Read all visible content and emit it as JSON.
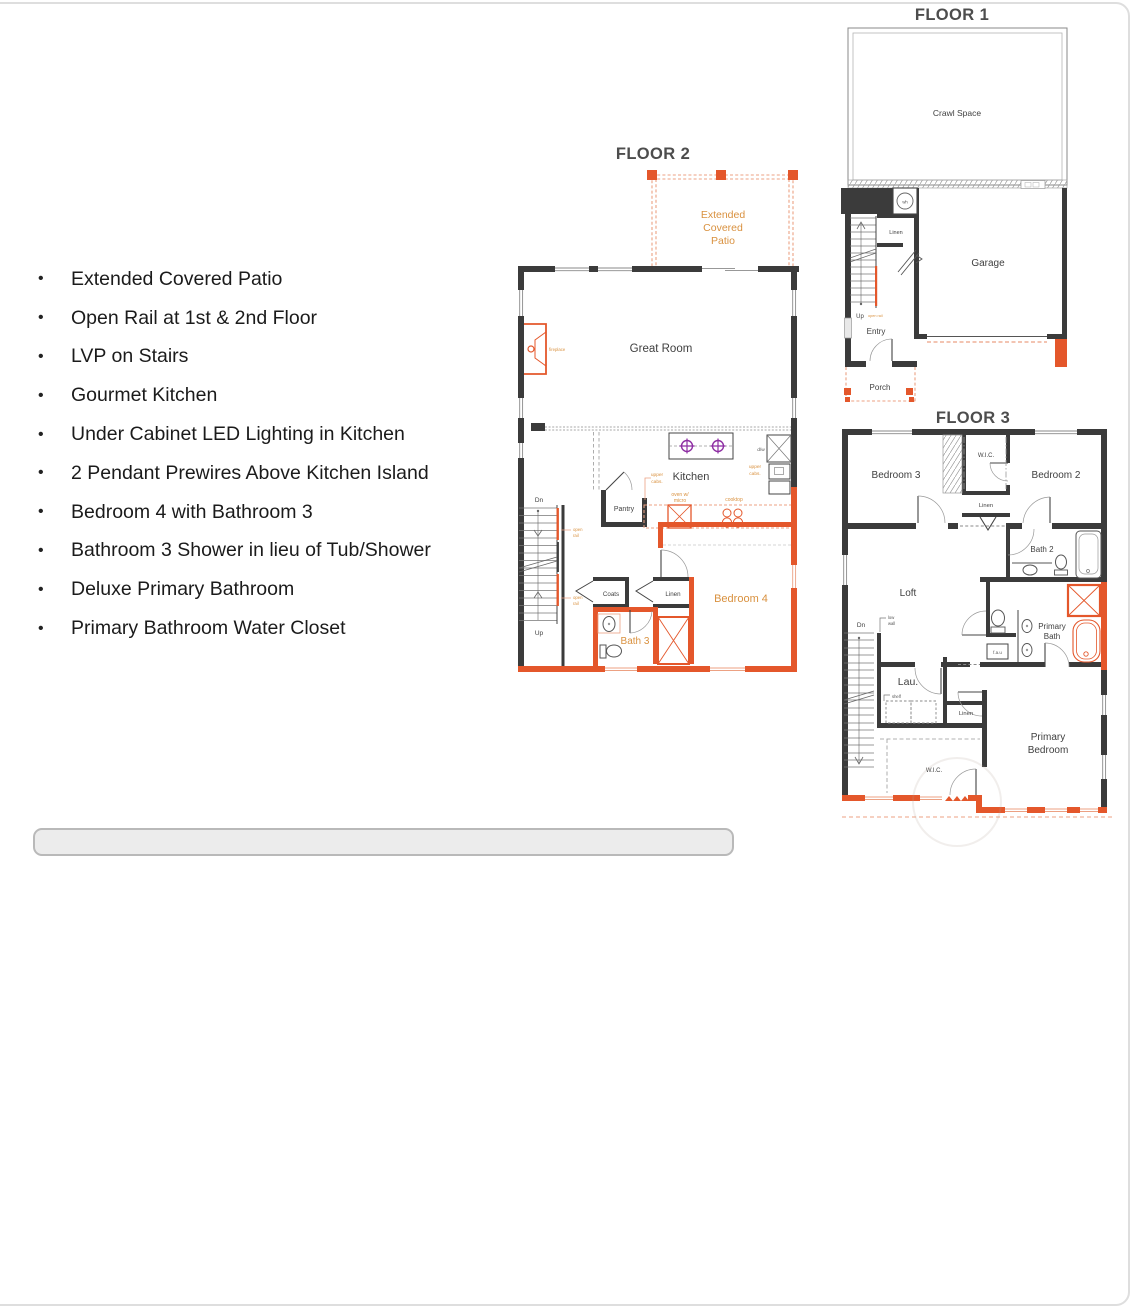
{
  "colors": {
    "option_orange": "#E4572B",
    "option_orange_light": "#ECA183",
    "label_orange": "#D9913F",
    "pendant_purple": "#8E2FA3",
    "wall_black": "#3B3B3B"
  },
  "features": [
    "Extended Covered Patio",
    "Open Rail at 1st & 2nd Floor",
    "LVP on Stairs",
    "Gourmet Kitchen",
    "Under Cabinet LED Lighting in Kitchen",
    "2 Pendant Prewires Above Kitchen Island",
    "Bedroom 4 with Bathroom 3",
    "Bathroom 3 Shower in lieu of Tub/Shower",
    "Deluxe Primary Bathroom",
    "Primary Bathroom Water Closet"
  ],
  "floor1": {
    "title": "FLOOR 1",
    "labels": {
      "crawl_space": "Crawl Space",
      "wh": "wh",
      "linen": "Linen",
      "garage": "Garage",
      "up": "Up",
      "open_rail": "open rail",
      "entry": "Entry",
      "porch": "Porch"
    }
  },
  "floor2": {
    "title": "FLOOR 2",
    "labels": {
      "patio": [
        "Extended",
        "Covered",
        "Patio"
      ],
      "great_room": "Great Room",
      "fireplace": "fireplace",
      "kitchen": "Kitchen",
      "dw": "d/w",
      "upper_cabs": [
        "upper",
        "cabs."
      ],
      "oven_micro": [
        "oven w/",
        "micro"
      ],
      "cooktop": "cooktop",
      "pantry": "Pantry",
      "dn": "Dn",
      "up": "Up",
      "open_rail": [
        "open",
        "rail"
      ],
      "coats": "Coats",
      "linen": "Linen",
      "bath3": "Bath 3",
      "bedroom4": "Bedroom 4"
    }
  },
  "floor3": {
    "title": "FLOOR 3",
    "labels": {
      "bedroom3": "Bedroom 3",
      "wic_top": "W.I.C.",
      "bedroom2": "Bedroom 2",
      "linen_top": "Linen",
      "bath2": "Bath 2",
      "loft": "Loft",
      "primary_bath": [
        "Primary",
        "Bath"
      ],
      "low_wall": [
        "low",
        "wall"
      ],
      "dn": "Dn",
      "lau": "Lau.",
      "shelf": "shelf",
      "fau": "f.a.u",
      "linen_mid": "Linen",
      "wic_bottom": "W.I.C.",
      "primary_bedroom": [
        "Primary",
        "Bedroom"
      ]
    }
  }
}
